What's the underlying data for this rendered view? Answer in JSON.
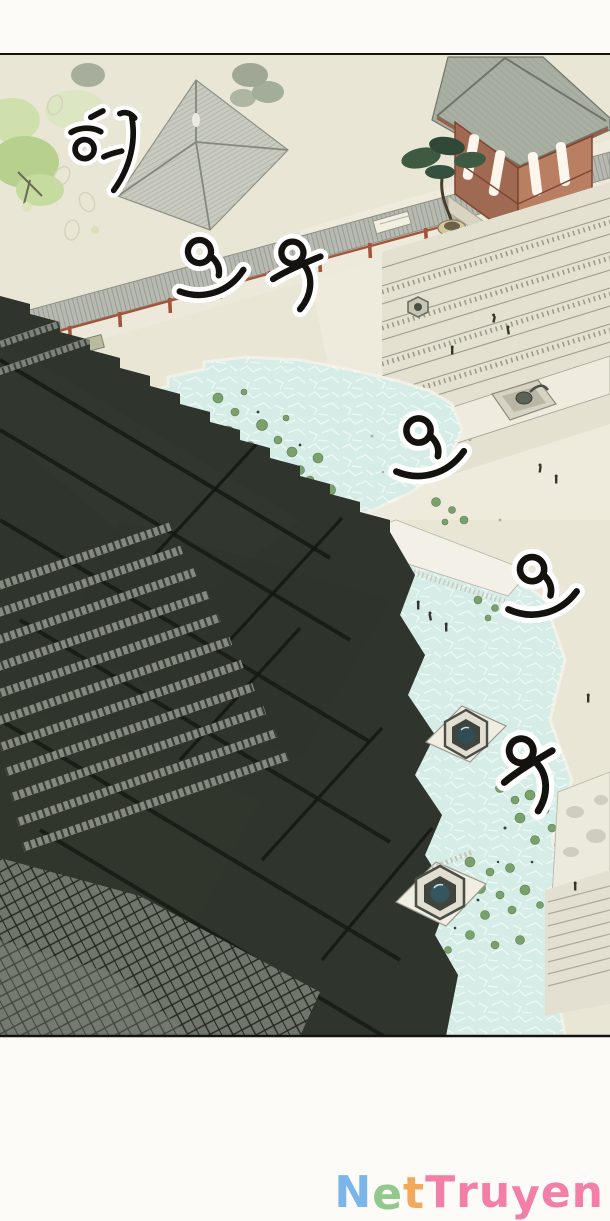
{
  "page": {
    "type": "manhwa-aerial-panel",
    "description": "Aerial view of a traditional palace complex: dark tiled roofs in the foreground, courtyards, terraces, a red pavilion, pine tree and lotus ponds, with wind sound-effect calligraphy."
  },
  "panel": {
    "top_border_y": 55,
    "bottom_border_y": 1036,
    "border_color": "#15130f",
    "background": "#e9e6d6"
  },
  "sfx": [
    {
      "char": "휘",
      "romanized": "hwi",
      "x": 112,
      "y": 152,
      "rot": 6,
      "scale": 0.95
    },
    {
      "char": "오",
      "romanized": "o",
      "x": 210,
      "y": 266,
      "rot": -8,
      "scale": 1.05
    },
    {
      "char": "우",
      "romanized": "u",
      "x": 297,
      "y": 271,
      "rot": -14,
      "scale": 1.05
    },
    {
      "char": "오",
      "romanized": "o",
      "x": 429,
      "y": 446,
      "rot": -6,
      "scale": 1.1
    },
    {
      "char": "오",
      "romanized": "o",
      "x": 542,
      "y": 585,
      "rot": -4,
      "scale": 1.1
    },
    {
      "char": "우",
      "romanized": "u",
      "x": 529,
      "y": 770,
      "rot": -22,
      "scale": 1.15
    }
  ],
  "watermark": {
    "text": "NetTruyen",
    "letters": [
      {
        "ch": "N",
        "color": "#7ab6e9"
      },
      {
        "ch": "e",
        "color": "#90c98b"
      },
      {
        "ch": "t",
        "color": "#f2a95c"
      },
      {
        "ch": "T",
        "color": "#f27fa8"
      },
      {
        "ch": "r",
        "color": "#f27fa8"
      },
      {
        "ch": "u",
        "color": "#f27fa8"
      },
      {
        "ch": "y",
        "color": "#f27fa8"
      },
      {
        "ch": "e",
        "color": "#f27fa8"
      },
      {
        "ch": "n",
        "color": "#f27fa8"
      }
    ]
  },
  "palette": {
    "canvas": "#fcfbf7",
    "ground": "#e9e6d6",
    "pond_water": "#d6ede7",
    "lily_pad": "#7aa06b",
    "dark_roof": "#30352d",
    "roof_eave_light": "#848a80",
    "corridor_roof": "#b7bab0",
    "red_column": "#a4543c",
    "pavilion_wood": "#b97f63",
    "pine_tree": "#3f5a42",
    "ink": "#14120e"
  }
}
